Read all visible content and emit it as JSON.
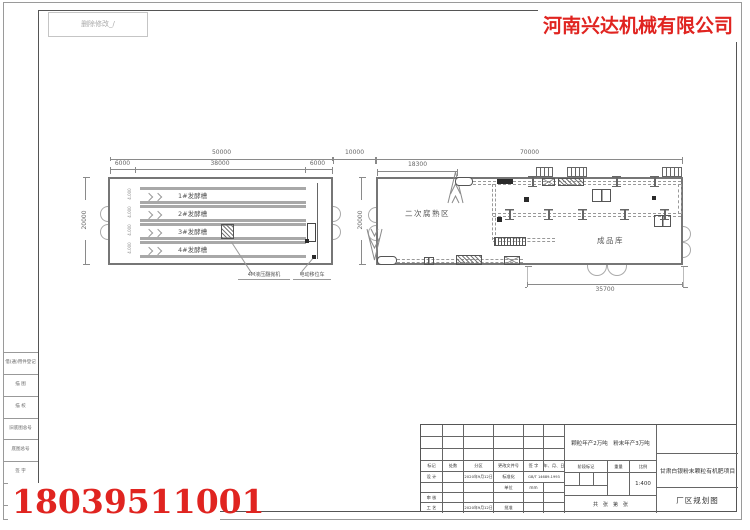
{
  "colors": {
    "brand_red": "#e02420",
    "wall_line": "#767676",
    "dim_line": "#8a8a8a"
  },
  "overlays": {
    "company_name": "河南兴达机械有限公司",
    "phone_number": "18039511001",
    "stamp_text": "删除修改_/"
  },
  "left_building": {
    "dims": {
      "total_width": "50000",
      "left_offset": "6000",
      "trough_length": "38000",
      "right_offset": "6000",
      "height": "20000",
      "pitch": [
        "4.000",
        "4.000",
        "4.000",
        "4.000"
      ]
    },
    "troughs": [
      {
        "label": "1#发酵槽"
      },
      {
        "label": "2#发酵槽"
      },
      {
        "label": "3#发酵槽"
      },
      {
        "label": "4#发酵槽"
      }
    ],
    "callout_turner": "4M液压翻抛机",
    "callout_cart": "电动移位车"
  },
  "site": {
    "gap_dim": "10000"
  },
  "right_building": {
    "dims": {
      "total_width": "70000",
      "inner_width": "18300",
      "height": "20000",
      "warehouse_depth": "12000",
      "bottom_width": "35700"
    },
    "zones": {
      "curing": "二次腐熟区",
      "warehouse": "成品库"
    }
  },
  "title_block": {
    "production_note": "颗粒年产2万吨　粉末年产3万吨",
    "project_name": "甘肃白银粉末颗粒有机肥项目",
    "drawing_title": "厂区规划图",
    "revision_header": [
      "标记",
      "处数",
      "分区",
      "更改文件号",
      "签 字",
      "年、月、日"
    ],
    "design_label": "设 计",
    "design_date": "2020年9月12日",
    "standard_label": "标准化",
    "standard_value": "GB/T 14689-1993",
    "unit_label": "单位",
    "unit_value": "mm",
    "check_label": "审 核",
    "process_label": "工 艺",
    "process_date": "2020年9月12日",
    "approve_label": "批准",
    "stage_mark_label": "阶段标记",
    "weight_label": "重量",
    "scale_label": "比例",
    "scale_value": "1:400",
    "sheet_note": "共　张　第　张"
  },
  "border_strip": [
    "借(通)用件登记",
    "描 图",
    "描 校",
    "旧底图总号",
    "底图总号",
    "签 字",
    "日 期"
  ]
}
